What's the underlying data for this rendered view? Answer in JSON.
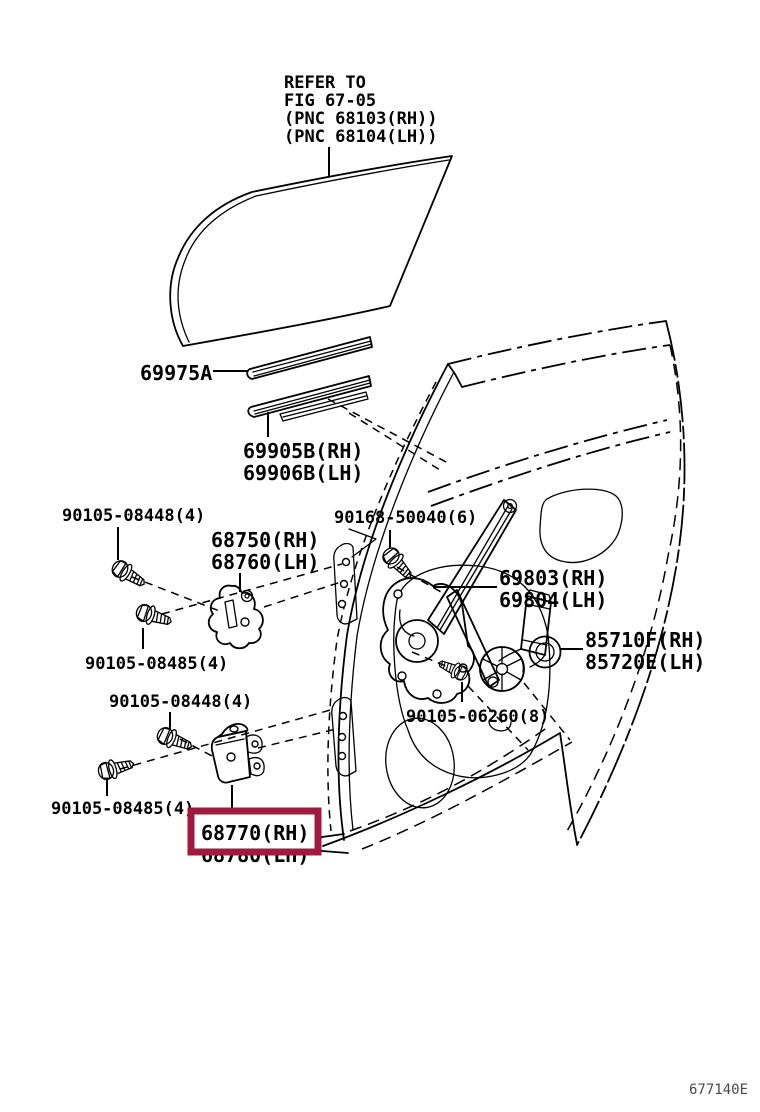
{
  "diagram": {
    "figure_ref": {
      "line1": "REFER TO",
      "line2": "FIG 67-05",
      "line3": "(PNC 68103(RH))",
      "line4": "(PNC 68104(LH))"
    },
    "labels": {
      "strip_outer": "69975A",
      "strip_inner_rh": "69905B(RH)",
      "strip_inner_lh": "69906B(LH)",
      "bolt_upper_hinge_a": "90105-08448(4)",
      "hinge_upper_rh": "68750(RH)",
      "hinge_upper_lh": "68760(LH)",
      "bolt_regulator": "90168-50040(6)",
      "regulator_rh": "69803(RH)",
      "regulator_lh": "69804(LH)",
      "motor_rh": "85710F(RH)",
      "motor_lh": "85720E(LH)",
      "bolt_upper_hinge_b": "90105-08485(4)",
      "bolt_lower_hinge_a": "90105-08448(4)",
      "bolt_motor": "90105-06260(8)",
      "bolt_lower_hinge_b": "90105-08485(4)",
      "hinge_lower_rh": "68770(RH)",
      "hinge_lower_lh": "68780(LH)"
    },
    "footer_code": "677140E",
    "colors": {
      "line": "#000000",
      "background": "#ffffff",
      "highlight_box": "#9E1B3F"
    }
  }
}
